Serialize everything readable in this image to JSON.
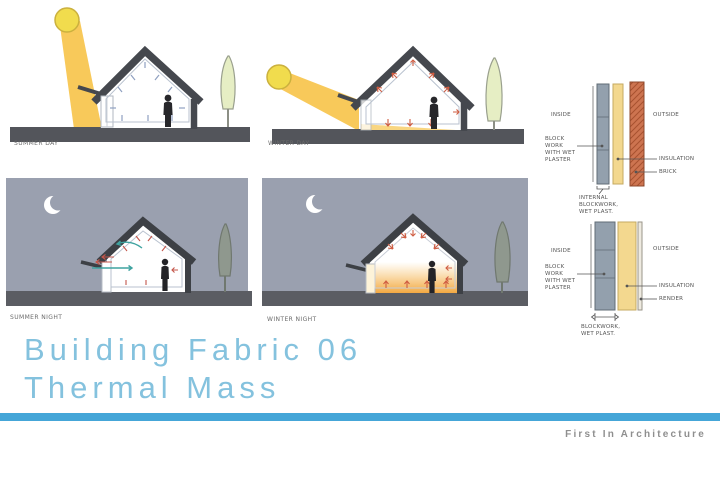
{
  "slide": {
    "title_line1": "Building Fabric 06",
    "title_line2": "Thermal Mass",
    "brand": "First In Architecture"
  },
  "diagrams": {
    "summer_day": {
      "label": "SUMMER DAY"
    },
    "winter_day": {
      "label": "WINTER DAY"
    },
    "summer_night": {
      "label": "SUMMER NIGHT"
    },
    "winter_night": {
      "label": "WINTER NIGHT"
    }
  },
  "wall_details": {
    "brick_wall": {
      "inside_label": "INSIDE",
      "outside_label": "OUTSIDE",
      "blockwork_label": "BLOCK WORK WITH WET PLASTER",
      "insulation_label": "INSULATION",
      "brick_label": "BRICK",
      "footnote": "INTERNAL BLOCKWORK, WET PLAST."
    },
    "render_wall": {
      "inside_label": "INSIDE",
      "outside_label": "OUTSIDE",
      "blockwork_label": "BLOCK WORK WITH WET PLASTER",
      "insulation_label": "INSULATION",
      "render_label": "RENDER",
      "footnote": "BLOCKWORK, WET PLAST."
    }
  },
  "colors": {
    "title_blue": "#84c2de",
    "bar_blue": "#45a6d8",
    "brand_gray": "#8f8f8f",
    "night_sky": "#9aa0af",
    "night_ground": "#5b5d63",
    "ground_gray": "#53555b",
    "roof_gray": "#45484e",
    "beam_yellow": "#f7c44c",
    "sun_yellow": "#f1dc4d",
    "heat_red": "#cf5c41",
    "vent_teal": "#3fa3a0",
    "moon_white": "#ffffff",
    "glow_amber": "#f2a438",
    "block_gray": "#93a0ad",
    "insulation_yellow": "#f3d88f",
    "brick_terracotta": "#cd7450",
    "tree_day": "#e6eec4",
    "tree_night": "#8f988e"
  }
}
